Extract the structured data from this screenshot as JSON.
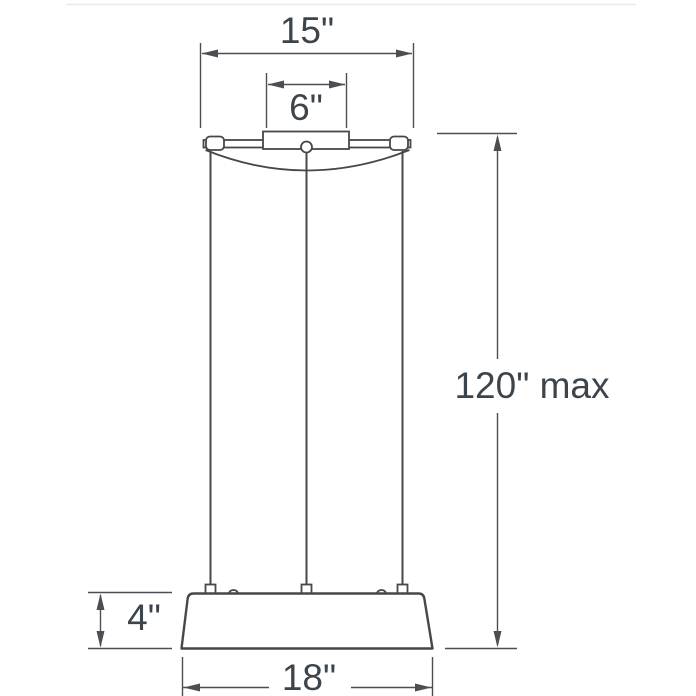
{
  "meta": {
    "type": "product-dimension-diagram",
    "subject": "suspended pendant light fixture with canopy, three cables and drum shade"
  },
  "colors": {
    "line": "#4b4e52",
    "fixture": "#45484b",
    "text": "#3d454c",
    "background": "#ffffff",
    "top_border": "#e8e9eb"
  },
  "dimensions": {
    "canopy_width": {
      "label": "15\"",
      "inches": 15
    },
    "canopy_mount_width": {
      "label": "6\"",
      "inches": 6
    },
    "suspension_max": {
      "label": "120\" max",
      "inches": 120,
      "qualifier": "max"
    },
    "shade_height": {
      "label": "4\"",
      "inches": 4
    },
    "shade_width": {
      "label": "18\"",
      "inches": 18
    }
  }
}
